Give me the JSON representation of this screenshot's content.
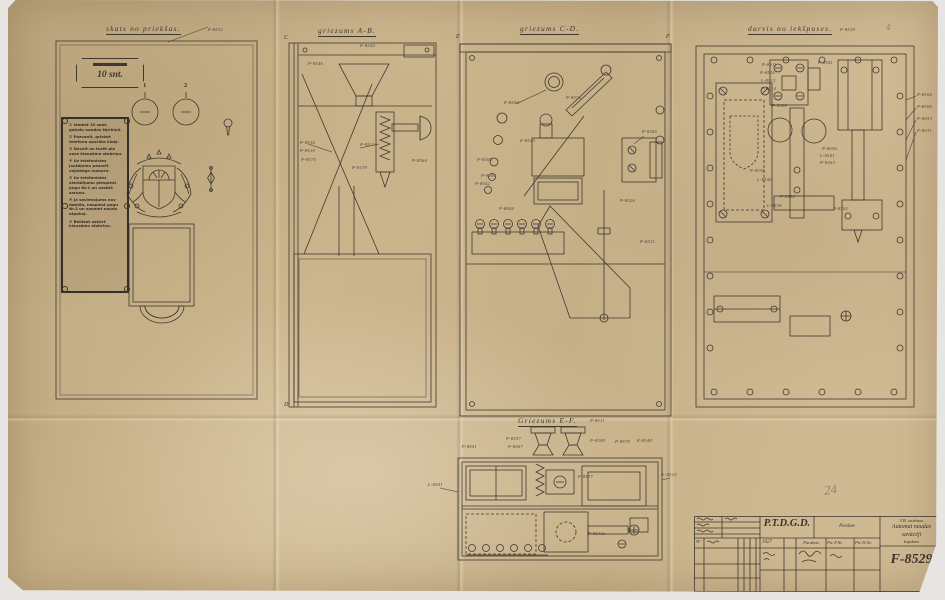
{
  "sheet": {
    "pencil_page_number": "24",
    "pencil_corner_mark": "4"
  },
  "panels": {
    "front": {
      "title": "skats no priekšas.",
      "part_no": "P-8532",
      "coin_plate": "10 snt.",
      "button_labels": [
        "1",
        "2"
      ],
      "instructions": [
        "① Iemest 10 sant. gabalu naudas šķirbiņā.",
        "② Pazvanīt, griežot telefona aparāta kloķi.",
        "③ Nocelt un turēt pie auss klausāmo stobriņu.",
        "④ Uz telefonistes jautājumu pasacīt vajadzīgo numuru.",
        "⑤ Uz telefonistes aizrādījumu piespiest pogu Nr.1 un uzsākt sarunu.",
        "⑥ Ja savienojums nav dabūts, nospiest pogu Nr.2 un saņemt naudu atpakaļ.",
        "⑦ Beidzot uzkārt klausāmo stobriņu."
      ]
    },
    "section_ab": {
      "title": "griezums A-B.",
      "marks": {
        "top": "C",
        "bottom": "D"
      },
      "labels": [
        "P-8546",
        "P-8544",
        "P-8516",
        "P-8519",
        "P-8575",
        "P-8513",
        "P-8564",
        "P-8578"
      ]
    },
    "section_cd": {
      "title": "griezums C-D.",
      "marks": {
        "left": "E",
        "right": "F"
      },
      "labels": [
        "P-8574",
        "P-8530",
        "P-8523",
        "P-8505",
        "P-8504",
        "P-8502",
        "P-8565",
        "P-8604",
        "P-8526",
        "P-8521"
      ]
    },
    "inside": {
      "title": "durvis no iekšpuses.",
      "part_no": "P-8539",
      "labels": [
        "P-8511",
        "P-8516",
        "L-8512",
        "P-8514",
        "P-8508",
        "P-8541",
        "P-8556",
        "L-8561",
        "P-8563",
        "P-8536",
        "L-8542",
        "P-8538",
        "L-8558",
        "P-8502"
      ],
      "margin_labels": [
        "P-8504",
        "P-8506",
        "P-8533",
        "P-8531"
      ]
    },
    "section_ef": {
      "title": "Griezums E-F.",
      "part_no": "P-8511",
      "labels": [
        "P-8557",
        "P-8567",
        "P-8551",
        "P-8577",
        "P-8549",
        "P-8579",
        "E-8548",
        "P-8530a",
        "L-8501",
        "L-8515"
      ]
    }
  },
  "title_block": {
    "org": "P.T.D.G.D.",
    "note_header": "Piezīme",
    "no_header": "Nº",
    "year": "1927",
    "signature_header": "Paraksts",
    "col_f": "Pie F.Nr.",
    "col_d": "Pie D.Nr.",
    "system": "V.B. sistēmas",
    "subject_line1": "Automat naudas",
    "subject_line2": "savācēji",
    "subject_line3": "kopskats",
    "drawing_no": "F-8529"
  }
}
